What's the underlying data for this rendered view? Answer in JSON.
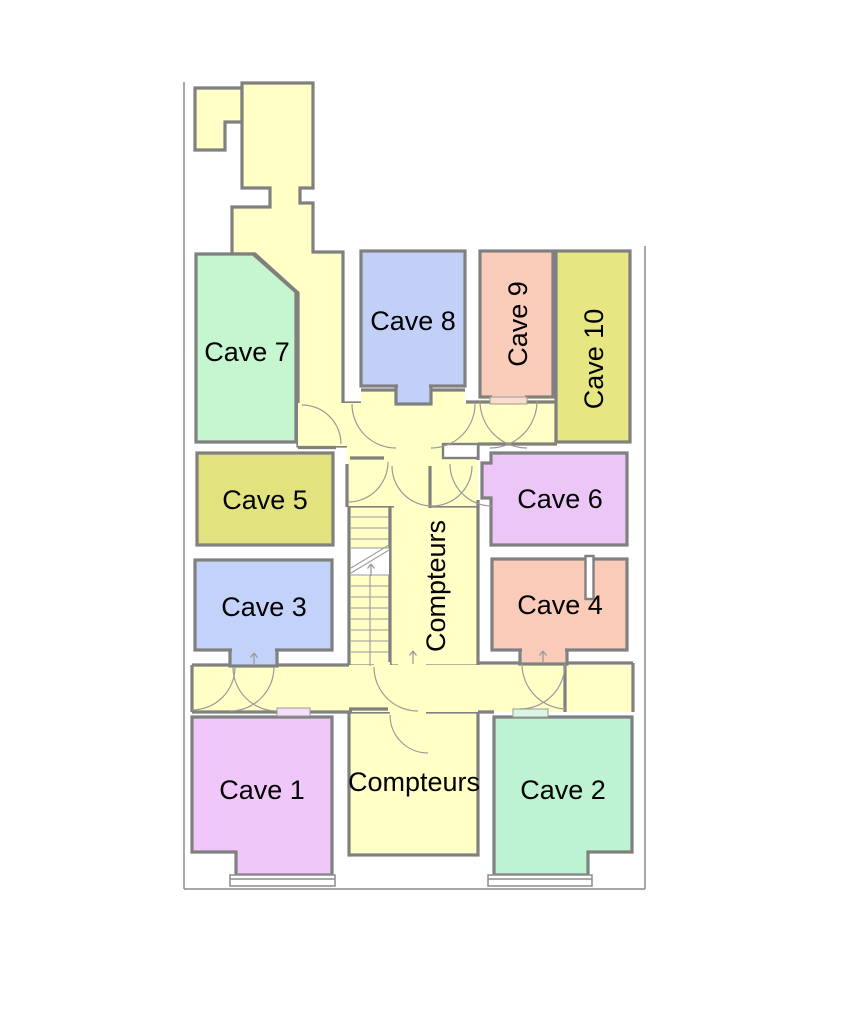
{
  "plan": {
    "rooms": [
      {
        "id": "cave-1",
        "label": "Cave 1",
        "color": "#EFC7F9"
      },
      {
        "id": "cave-2",
        "label": "Cave 2",
        "color": "#BDF2D3"
      },
      {
        "id": "cave-3",
        "label": "Cave 3",
        "color": "#C2D2F8"
      },
      {
        "id": "cave-4",
        "label": "Cave 4",
        "color": "#FACBB8"
      },
      {
        "id": "cave-5",
        "label": "Cave 5",
        "color": "#E2E27E"
      },
      {
        "id": "cave-6",
        "label": "Cave 6",
        "color": "#EDC6F8"
      },
      {
        "id": "cave-7",
        "label": "Cave 7",
        "color": "#C5F6CF"
      },
      {
        "id": "cave-8",
        "label": "Cave 8",
        "color": "#C2D0F8"
      },
      {
        "id": "cave-9",
        "label": "Cave 9",
        "color": "#FACDBA"
      },
      {
        "id": "cave-10",
        "label": "Cave 10",
        "color": "#E6E682"
      }
    ],
    "utility_rooms": [
      {
        "id": "compteurs-upper",
        "label": "Compteurs"
      },
      {
        "id": "compteurs-lower",
        "label": "Compteurs"
      }
    ],
    "colors": {
      "corridor": "#FFFFC6",
      "wall": "#808080",
      "boundary": "#8C8C8C",
      "door_arc": "#9A9A9A",
      "label_text": "#000000",
      "landing": "#FFFFFF",
      "sill_cave1": "#F6DDF8",
      "sill_cave2": "#D9F6E3",
      "sill_cave9": "#FBDCCB"
    }
  }
}
